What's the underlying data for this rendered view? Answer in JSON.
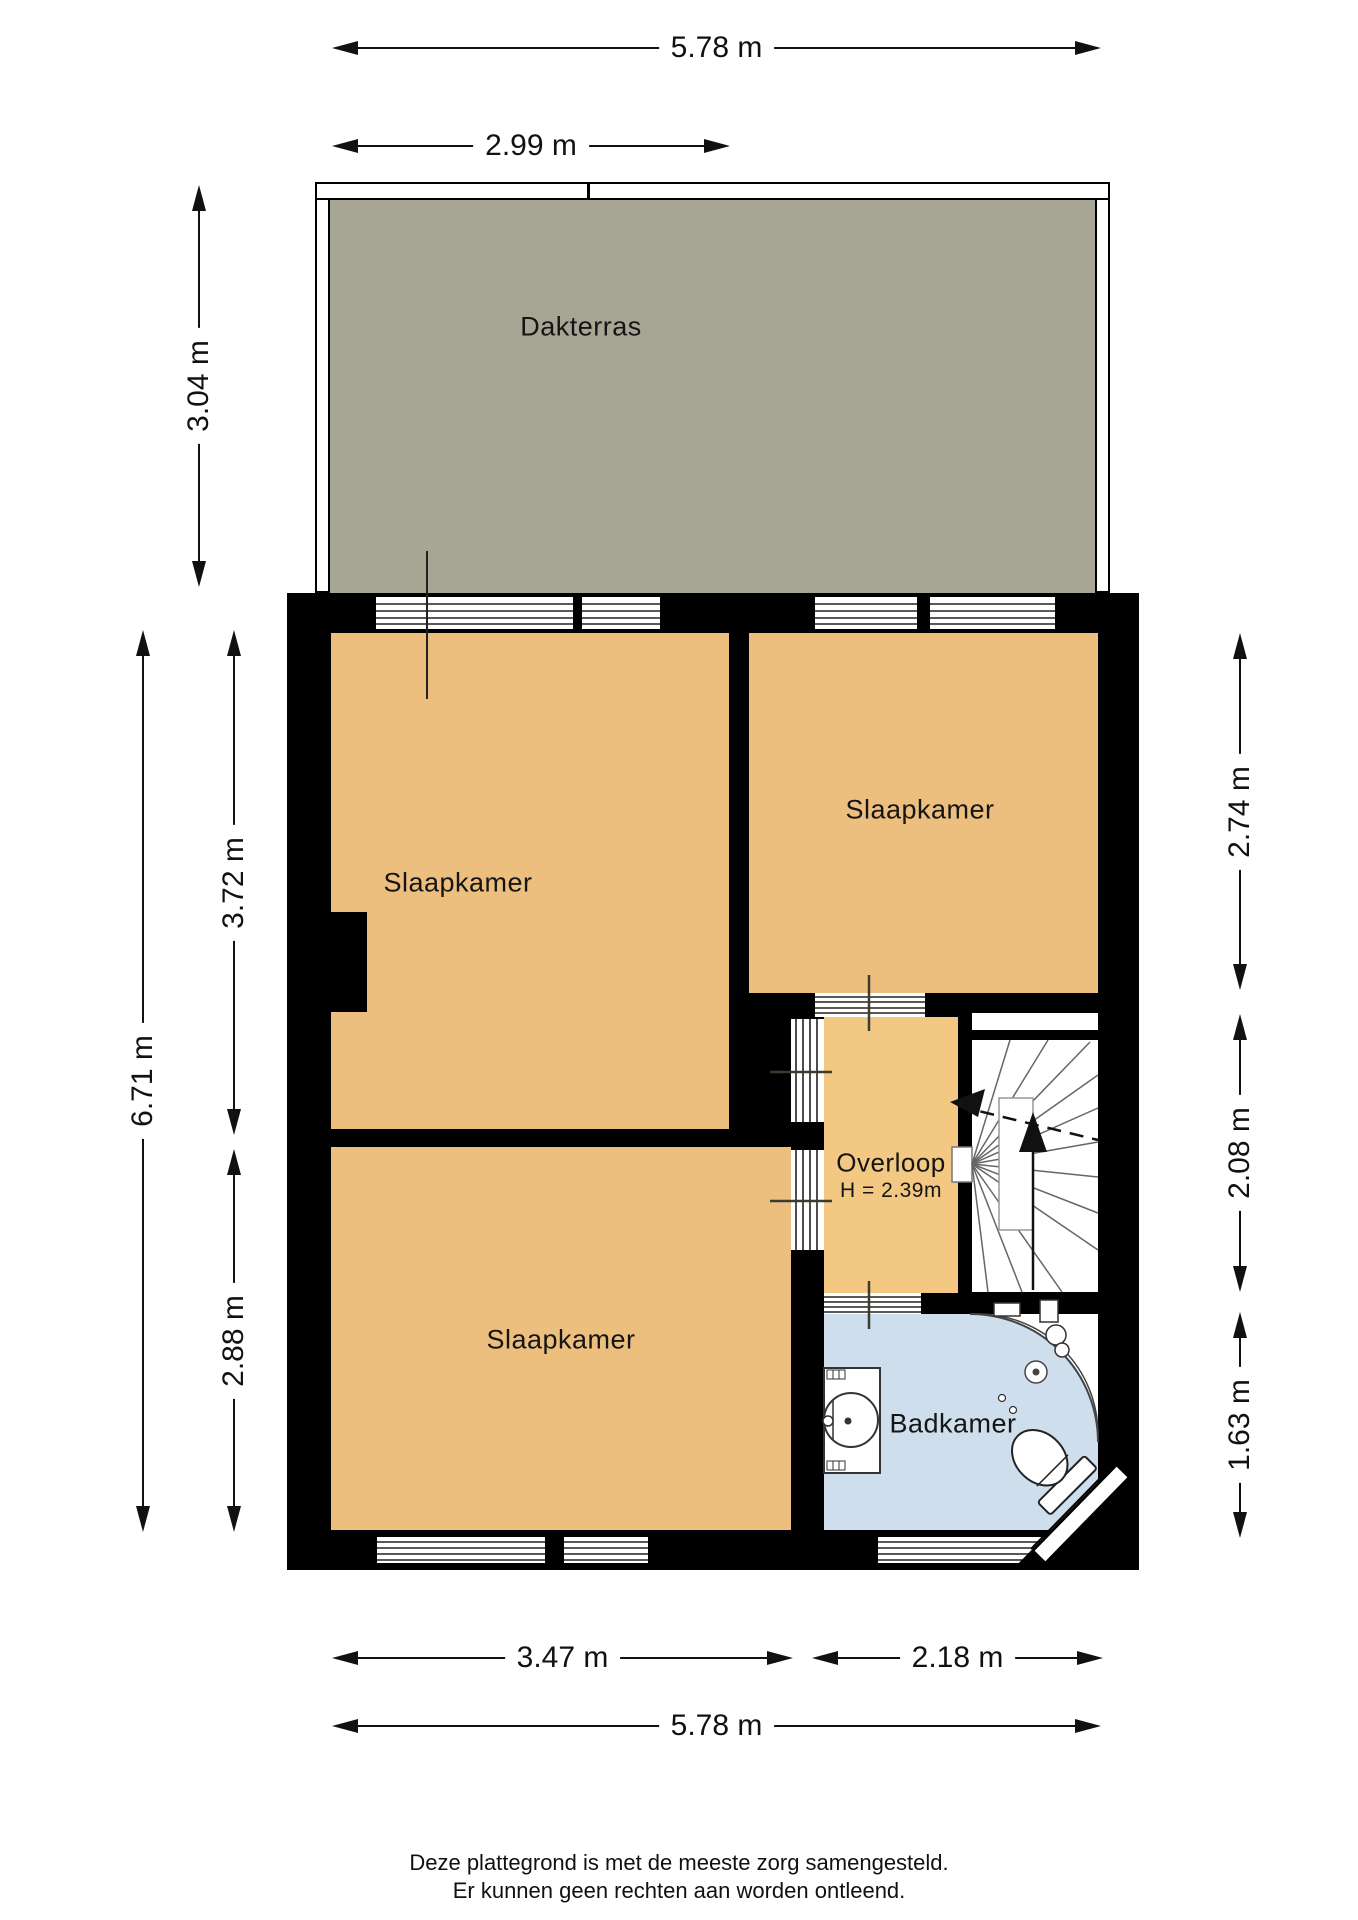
{
  "rooms": {
    "dakterras": {
      "label": "Dakterras"
    },
    "slaapkamer_1": {
      "label": "Slaapkamer"
    },
    "slaapkamer_2": {
      "label": "Slaapkamer"
    },
    "slaapkamer_3": {
      "label": "Slaapkamer"
    },
    "overloop": {
      "label": "Overloop",
      "ceiling_height": "H = 2.39m"
    },
    "badkamer": {
      "label": "Badkamer"
    }
  },
  "dimensions": {
    "top_total": "5.78 m",
    "top_terrace_partial": "2.99 m",
    "left_terrace_depth": "3.04 m",
    "left_total": "6.71 m",
    "left_slaapkamer_boven": "3.72 m",
    "left_slaapkamer_onder": "2.88 m",
    "right_slaapkamer": "2.74 m",
    "right_overloop": "2.08 m",
    "right_badkamer": "1.63 m",
    "bottom_slaapkamer": "3.47 m",
    "bottom_badkamer": "2.18 m",
    "bottom_total": "5.78 m"
  },
  "footer": {
    "line1": "Deze plattegrond is met de meeste zorg samengesteld.",
    "line2": "Er kunnen geen rechten aan worden ontleend."
  },
  "colors": {
    "wall": "#000000",
    "bedroom_fill": "#edbf7e",
    "overloop_fill": "#f3c883",
    "bathroom_fill": "#cfdeed",
    "terrace_fill": "#a7a593",
    "background": "#ffffff"
  }
}
